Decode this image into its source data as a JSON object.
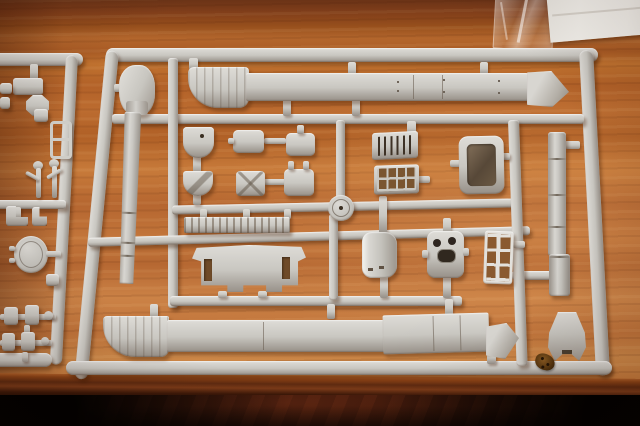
{
  "scene": {
    "type": "photograph",
    "subject": "Light grey injection-molded plastic model kit sprues with tank parts",
    "surface": "orange-brown wooden table; front table edge and dark shadowed floor visible at bottom",
    "lighting": "warm indoor light from upper left casting small shadows under the sprue rails",
    "text_visible": "none"
  },
  "colors": {
    "plastic": "#c9c7c1",
    "plasticHi": "#dedcd7",
    "plasticLo": "#968f87",
    "woodMid": "#b4662e",
    "woodLight": "#cd8848",
    "woodDark": "#7e3f1d",
    "tableEdge": "#5e2b12",
    "floorDark": "#1d0c05",
    "paper": "#f2f0eb",
    "film": "#f7f5f1",
    "debris": "#6b4a20"
  },
  "objects": {
    "main_sprue": {
      "label": "large grey sprue frame filling most of the frame",
      "parts": [
        "long hull side strip with curved fender end (top row)",
        "angled strip end piece",
        "gun barrel with bulbous mantlet (left, hanging down)",
        "second gun barrel shaft (right, vertical)",
        "flared muzzle / breech piece (bottom right)",
        "two half-round hatch covers",
        "four rounded stowage boxes",
        "louvered engine grille",
        "mesh grille screen",
        "rectangular hatch frame (open centre)",
        "round wheel cap",
        "notched track strip",
        "wide rear hull plate with two slots",
        "curved hatch shell",
        "back plate with two round holes and oval opening",
        "ladder-style lattice",
        "long hull side strip with curved end (bottom row)"
      ]
    },
    "left_sprue": {
      "label": "second sprue partially visible at left edge",
      "parts": [
        "small rectangular plate",
        "octagonal cap",
        "small ladder bracket",
        "two figure-like sprigs",
        "round hatch with side tabs",
        "two axle assemblies with knobs",
        "assorted small fittings"
      ]
    },
    "paper_sheet": {
      "label": "white paper sheet at top right corner"
    },
    "plastic_film": {
      "label": "crumpled clear wrapping film beside the paper"
    },
    "debris": {
      "label": "small brown leaf fragment on the table near bottom right"
    }
  }
}
